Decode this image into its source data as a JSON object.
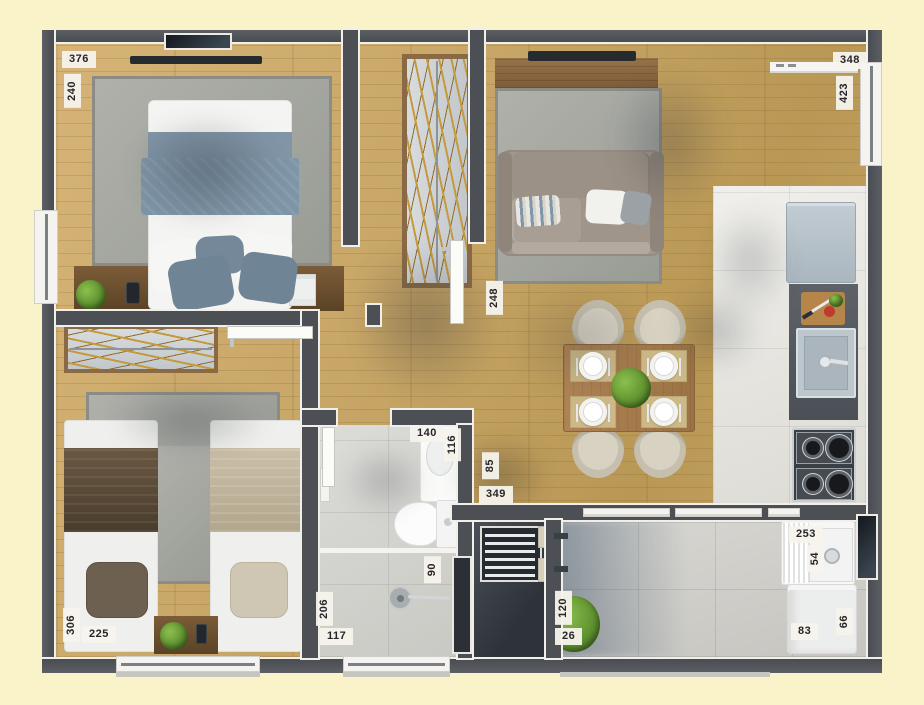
{
  "measurements": [
    {
      "value": "376"
    },
    {
      "value": "240"
    },
    {
      "value": "348"
    },
    {
      "value": "423"
    },
    {
      "value": "248"
    },
    {
      "value": "140"
    },
    {
      "value": "116"
    },
    {
      "value": "85"
    },
    {
      "value": "349"
    },
    {
      "value": "90"
    },
    {
      "value": "206"
    },
    {
      "value": "117"
    },
    {
      "value": "306"
    },
    {
      "value": "225"
    },
    {
      "value": "120"
    },
    {
      "value": "26"
    },
    {
      "value": "253"
    },
    {
      "value": "54"
    },
    {
      "value": "83"
    },
    {
      "value": "66"
    }
  ],
  "colors": {
    "background": "#faf2c8",
    "wall": "#4c5055",
    "wall_outline": "#f1efe9",
    "wood_floor": "#c9a768",
    "kitchen_tile": "#e8e7e2",
    "bathroom_tile": "#d3d3ce",
    "service_tile": "#cfcec9",
    "rug": "#a5a6a0",
    "bed_blanket": "#7e95a7",
    "label_bg": "#f5f3ec",
    "label_text": "#26262a",
    "plant": "#5d8f2e",
    "counter": "#565b61"
  }
}
